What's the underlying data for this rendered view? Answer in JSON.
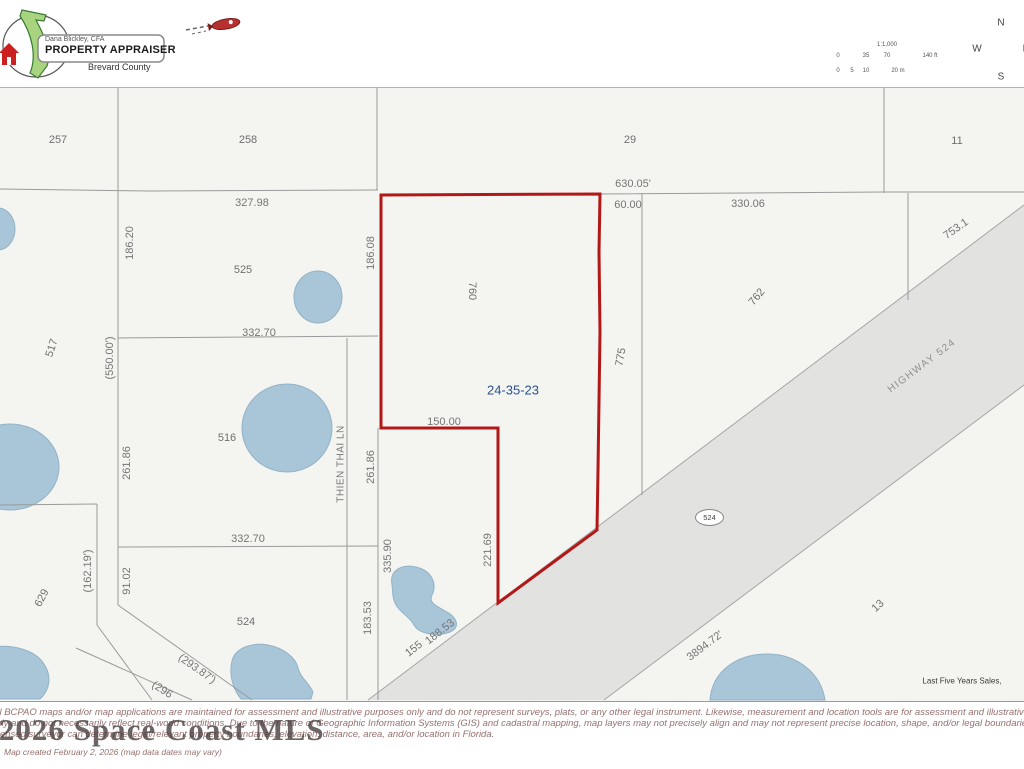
{
  "header": {
    "logo": {
      "owner_line": "Dana Blickley, CFA",
      "title": "PROPERTY APPRAISER",
      "county": "Brevard County"
    },
    "scale_bar": {
      "ratio": "1:1,000"
    },
    "compass": {
      "n": "N",
      "s": "S",
      "e": "E",
      "w": "W"
    }
  },
  "map": {
    "highlight_parcel_id": "24-35-23",
    "street": "THIEN THAI LN",
    "highway_name": "HIGHWAY 524",
    "route_shield": "524",
    "colors": {
      "parcel_line": "#9a9a9a",
      "highlight_outline": "#b21818",
      "water": "#a9c5d8",
      "highway_fill": "#e2e2e1",
      "section_label": "#2a5290"
    },
    "positioned_labels": [
      {
        "t": "257",
        "x": 58,
        "y": 140,
        "cls": "parcel"
      },
      {
        "t": "258",
        "x": 248,
        "y": 140,
        "cls": "parcel"
      },
      {
        "t": "29",
        "x": 630,
        "y": 140,
        "cls": "parcel"
      },
      {
        "t": "11",
        "x": 957,
        "y": 141,
        "cls": "parcel"
      },
      {
        "t": "327.98",
        "x": 252,
        "y": 203,
        "cls": "dim"
      },
      {
        "t": "630.05'",
        "x": 633,
        "y": 184,
        "cls": "dim"
      },
      {
        "t": "60.00",
        "x": 628,
        "y": 205,
        "cls": "dim"
      },
      {
        "t": "330.06",
        "x": 748,
        "y": 204,
        "cls": "dim"
      },
      {
        "t": "753.1",
        "x": 956,
        "y": 229,
        "r": -35,
        "cls": "dim"
      },
      {
        "t": "186.20",
        "x": 130,
        "y": 243,
        "r": -90,
        "cls": "dim"
      },
      {
        "t": "186.08",
        "x": 371,
        "y": 253,
        "r": -90,
        "cls": "dim"
      },
      {
        "t": "525",
        "x": 243,
        "y": 270,
        "cls": "parcel"
      },
      {
        "t": "760",
        "x": 472,
        "y": 291,
        "r": 90,
        "cls": "parcel"
      },
      {
        "t": "762",
        "x": 757,
        "y": 297,
        "r": -50,
        "cls": "parcel"
      },
      {
        "t": "332.70",
        "x": 259,
        "y": 333,
        "cls": "dim"
      },
      {
        "t": "(550.00')",
        "x": 110,
        "y": 358,
        "r": -90,
        "cls": "dim"
      },
      {
        "t": "517",
        "x": 52,
        "y": 348,
        "r": -72,
        "cls": "parcel"
      },
      {
        "t": "775",
        "x": 621,
        "y": 357,
        "r": -80,
        "cls": "parcel"
      },
      {
        "t": "HIGHWAY 524",
        "x": 922,
        "y": 366,
        "r": -37,
        "cls": "hwy",
        "n": "highway-label"
      },
      {
        "t": "24-35-23",
        "x": 513,
        "y": 390,
        "cls": "blue",
        "n": "section-township-range-label"
      },
      {
        "t": "150.00",
        "x": 444,
        "y": 422,
        "cls": "dim"
      },
      {
        "t": "516",
        "x": 227,
        "y": 438,
        "cls": "parcel"
      },
      {
        "t": "261.86",
        "x": 127,
        "y": 463,
        "r": -90,
        "cls": "dim"
      },
      {
        "t": "THIEN THAI LN",
        "x": 341,
        "y": 464,
        "r": -90,
        "cls": "street",
        "n": "street-label"
      },
      {
        "t": "261.86",
        "x": 371,
        "y": 467,
        "r": -90,
        "cls": "dim"
      },
      {
        "t": "332.70",
        "x": 248,
        "y": 539,
        "cls": "dim"
      },
      {
        "t": "(162.19')",
        "x": 88,
        "y": 571,
        "r": -90,
        "cls": "dim"
      },
      {
        "t": "91.02",
        "x": 127,
        "y": 581,
        "r": -90,
        "cls": "dim"
      },
      {
        "t": "335.90",
        "x": 388,
        "y": 556,
        "r": -90,
        "cls": "dim"
      },
      {
        "t": "221.69",
        "x": 488,
        "y": 550,
        "r": -90,
        "cls": "dim"
      },
      {
        "t": "183.53",
        "x": 368,
        "y": 618,
        "r": -90,
        "cls": "dim"
      },
      {
        "t": "629",
        "x": 42,
        "y": 598,
        "r": -62,
        "cls": "parcel"
      },
      {
        "t": "524",
        "x": 246,
        "y": 622,
        "cls": "parcel"
      },
      {
        "t": "(293.87')",
        "x": 197,
        "y": 669,
        "r": 35,
        "cls": "dim"
      },
      {
        "t": "(296",
        "x": 162,
        "y": 690,
        "r": 33,
        "cls": "dim"
      },
      {
        "t": "155",
        "x": 414,
        "y": 649,
        "r": -38,
        "cls": "dim"
      },
      {
        "t": "188.53",
        "x": 440,
        "y": 632,
        "r": -38,
        "cls": "dim"
      },
      {
        "t": "3894.72'",
        "x": 705,
        "y": 646,
        "r": -37,
        "cls": "dim"
      },
      {
        "t": "13",
        "x": 878,
        "y": 606,
        "r": -42,
        "cls": "parcel"
      },
      {
        "t": "Last Five Years Sales,",
        "x": 962,
        "y": 681,
        "cls": "sales",
        "n": "sales-note"
      },
      {
        "t": "1:1,000",
        "x": 887,
        "y": 45,
        "cls": "tiny",
        "n": "scale-ratio"
      },
      {
        "t": "0",
        "x": 838,
        "y": 56,
        "cls": "tiny",
        "n": "scale-tick"
      },
      {
        "t": "35",
        "x": 866,
        "y": 56,
        "cls": "tiny",
        "n": "scale-tick"
      },
      {
        "t": "70",
        "x": 887,
        "y": 56,
        "cls": "tiny",
        "n": "scale-tick"
      },
      {
        "t": "140 ft",
        "x": 930,
        "y": 56,
        "cls": "tiny",
        "n": "scale-tick"
      },
      {
        "t": "0",
        "x": 838,
        "y": 71,
        "cls": "tiny",
        "n": "scale-tick"
      },
      {
        "t": "5",
        "x": 852,
        "y": 71,
        "cls": "tiny",
        "n": "scale-tick"
      },
      {
        "t": "10",
        "x": 866,
        "y": 71,
        "cls": "tiny",
        "n": "scale-tick"
      },
      {
        "t": "20 m",
        "x": 898,
        "y": 71,
        "cls": "tiny",
        "n": "scale-tick"
      },
      {
        "t": "N",
        "x": 1001,
        "y": 23,
        "cls": "compass",
        "n": "compass-n"
      },
      {
        "t": "S",
        "x": 1001,
        "y": 77,
        "cls": "compass",
        "n": "compass-s"
      },
      {
        "t": "W",
        "x": 977,
        "y": 49,
        "cls": "compass",
        "n": "compass-w"
      },
      {
        "t": "E",
        "x": 1026,
        "y": 49,
        "cls": "compass",
        "n": "compass-e"
      }
    ]
  },
  "footer": {
    "watermark": "© 2026 Space Coast MLS",
    "disclaimer_line1": "All BCPAO maps and/or map applications are maintained for assessment and illustrative purposes only and do not represent surveys, plats, or any other legal instrument. Likewise, measurement and location tools are for assessment and illustrative purposes",
    "disclaimer_line2": "only and do not necessarily reflect real-world conditions. Due to the nature of Geographic Information Systems (GIS) and cadastral mapping, map layers may not precisely align and may not represent precise location, shape, and/or legal boundaries. Only a",
    "disclaimer_line3": "licensed surveyor can determine legal/relevant property boundaries, elevation, distance, area, and/or location in Florida.",
    "map_created": "Map created February 2, 2026 (map data dates may vary)"
  }
}
